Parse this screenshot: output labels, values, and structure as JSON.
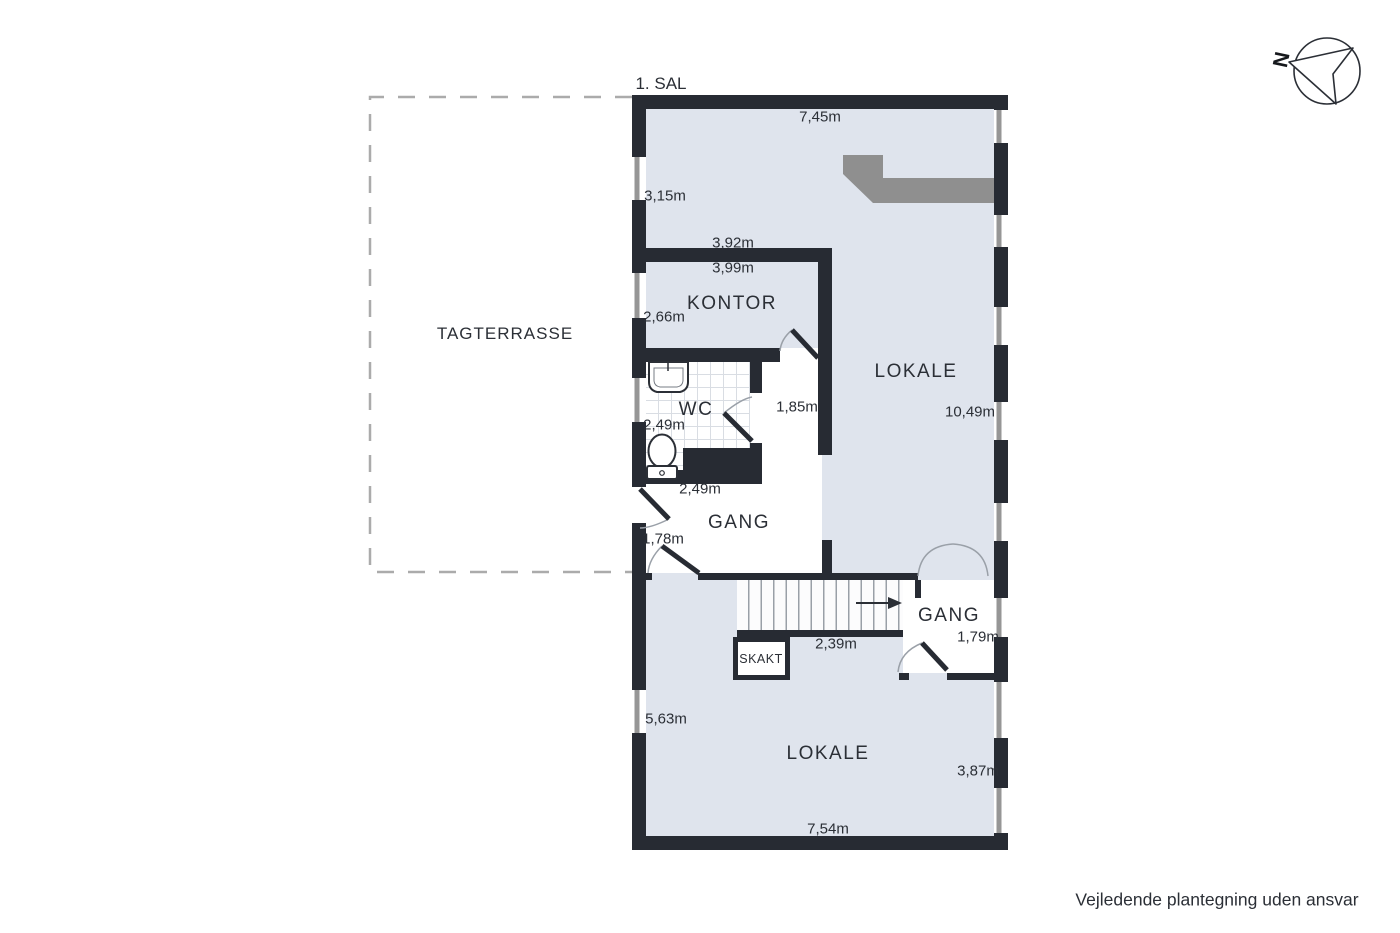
{
  "title": "1. SAL",
  "disclaimer": "Vejledende plantegning uden ansvar",
  "compass": {
    "north": "N"
  },
  "terrace": {
    "name": "TAGTERRASSE"
  },
  "rooms": {
    "kontor": "KONTOR",
    "wc": "WC",
    "lokale_upper": "LOKALE",
    "lokale_lower": "LOKALE",
    "gang_upper": "GANG",
    "gang_lower": "GANG",
    "skakt": "SKAKT"
  },
  "dimensions": {
    "top_width": "7,45m",
    "upper_left_height": "3,15m",
    "kontor_outer_width": "3,92m",
    "kontor_width": "3,99m",
    "kontor_height": "2,66m",
    "wc_height": "2,49m",
    "wc_width": "2,49m",
    "inner_hall_width": "1,85m",
    "lokale_upper_height": "10,49m",
    "terrace_door_width": "1,78m",
    "stair_width": "2,39m",
    "gang_lower_width": "1,79m",
    "lokale_lower_left_height": "5,63m",
    "lokale_lower_right_height": "3,87m",
    "lokale_lower_width": "7,54m"
  },
  "colors": {
    "wall": "#272b33",
    "floor": "#dfe4ed",
    "room_white": "#ffffff",
    "counter": "#8f8f8f",
    "text": "#2b2f36",
    "terrace_dash": "#ababab"
  }
}
